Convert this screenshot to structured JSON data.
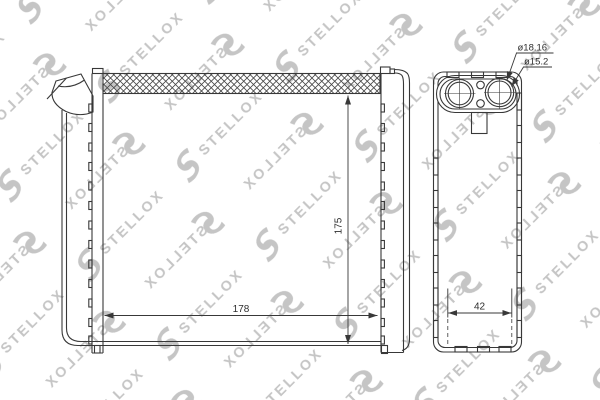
{
  "drawing": {
    "watermark_text": "STELLOX",
    "front_view": {
      "width_dim": "178",
      "height_dim": "175"
    },
    "side_view": {
      "depth_dim": "42",
      "port_outer_diameter": "ø18.16",
      "port_inner_diameter": "ø15.2"
    },
    "colors": {
      "background": "#ffffff",
      "line": "#383838",
      "dimension_text": "#2e2e2e",
      "watermark": "#c5c5c5"
    }
  }
}
